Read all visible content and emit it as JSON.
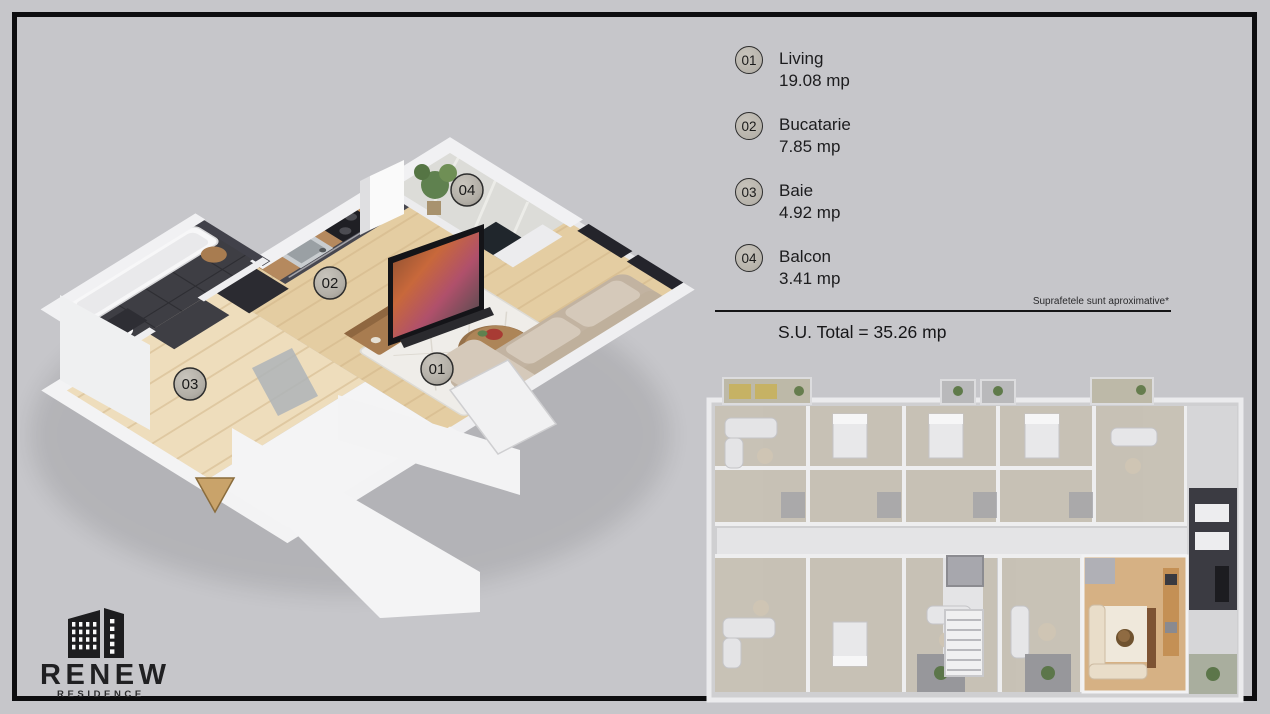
{
  "palette": {
    "canvas_bg": "#c6c6ca",
    "frame": "#0d0d0f",
    "ink": "#1d1d1f",
    "badge_fill": "#b7b3ab",
    "badge_ring": "#2d2d2d",
    "wood": "#e4cda2",
    "wood_dark": "#d0b385",
    "hall_wood": "#eeddbc",
    "tile_dark": "#3e3e44",
    "wall": "#f1f1f3",
    "wall_shade": "#dadadc",
    "cabinet": "#474750",
    "counter_wood": "#b5895e",
    "appliance": "#1f1f24",
    "sofa": "#d5c9ba",
    "sofa_shade": "#c2b3a1",
    "rug": "#efede9",
    "window_glass": "#24242b",
    "plant": "#5f814f",
    "console_wood": "#a87c50",
    "arrow_tan": "#c9a36a",
    "bld_wall": "#ebebed",
    "bld_floor": "#c7c0b2",
    "bld_dark": "#3b3b42",
    "bld_hl_wood": "#d6b184",
    "bld_corridor": "#e4e4e6"
  },
  "legend": {
    "rooms": [
      {
        "num": "01",
        "name": "Living",
        "area": "19.08 mp"
      },
      {
        "num": "02",
        "name": "Bucatarie",
        "area": "7.85 mp"
      },
      {
        "num": "03",
        "name": "Baie",
        "area": "4.92 mp"
      },
      {
        "num": "04",
        "name": "Balcon",
        "area": "3.41 mp"
      }
    ],
    "note": "Suprafetele sunt aproximative*",
    "total": "S.U. Total = 35.26 mp"
  },
  "logo": {
    "name": "RENEW",
    "subtitle": "RESIDENCE"
  }
}
